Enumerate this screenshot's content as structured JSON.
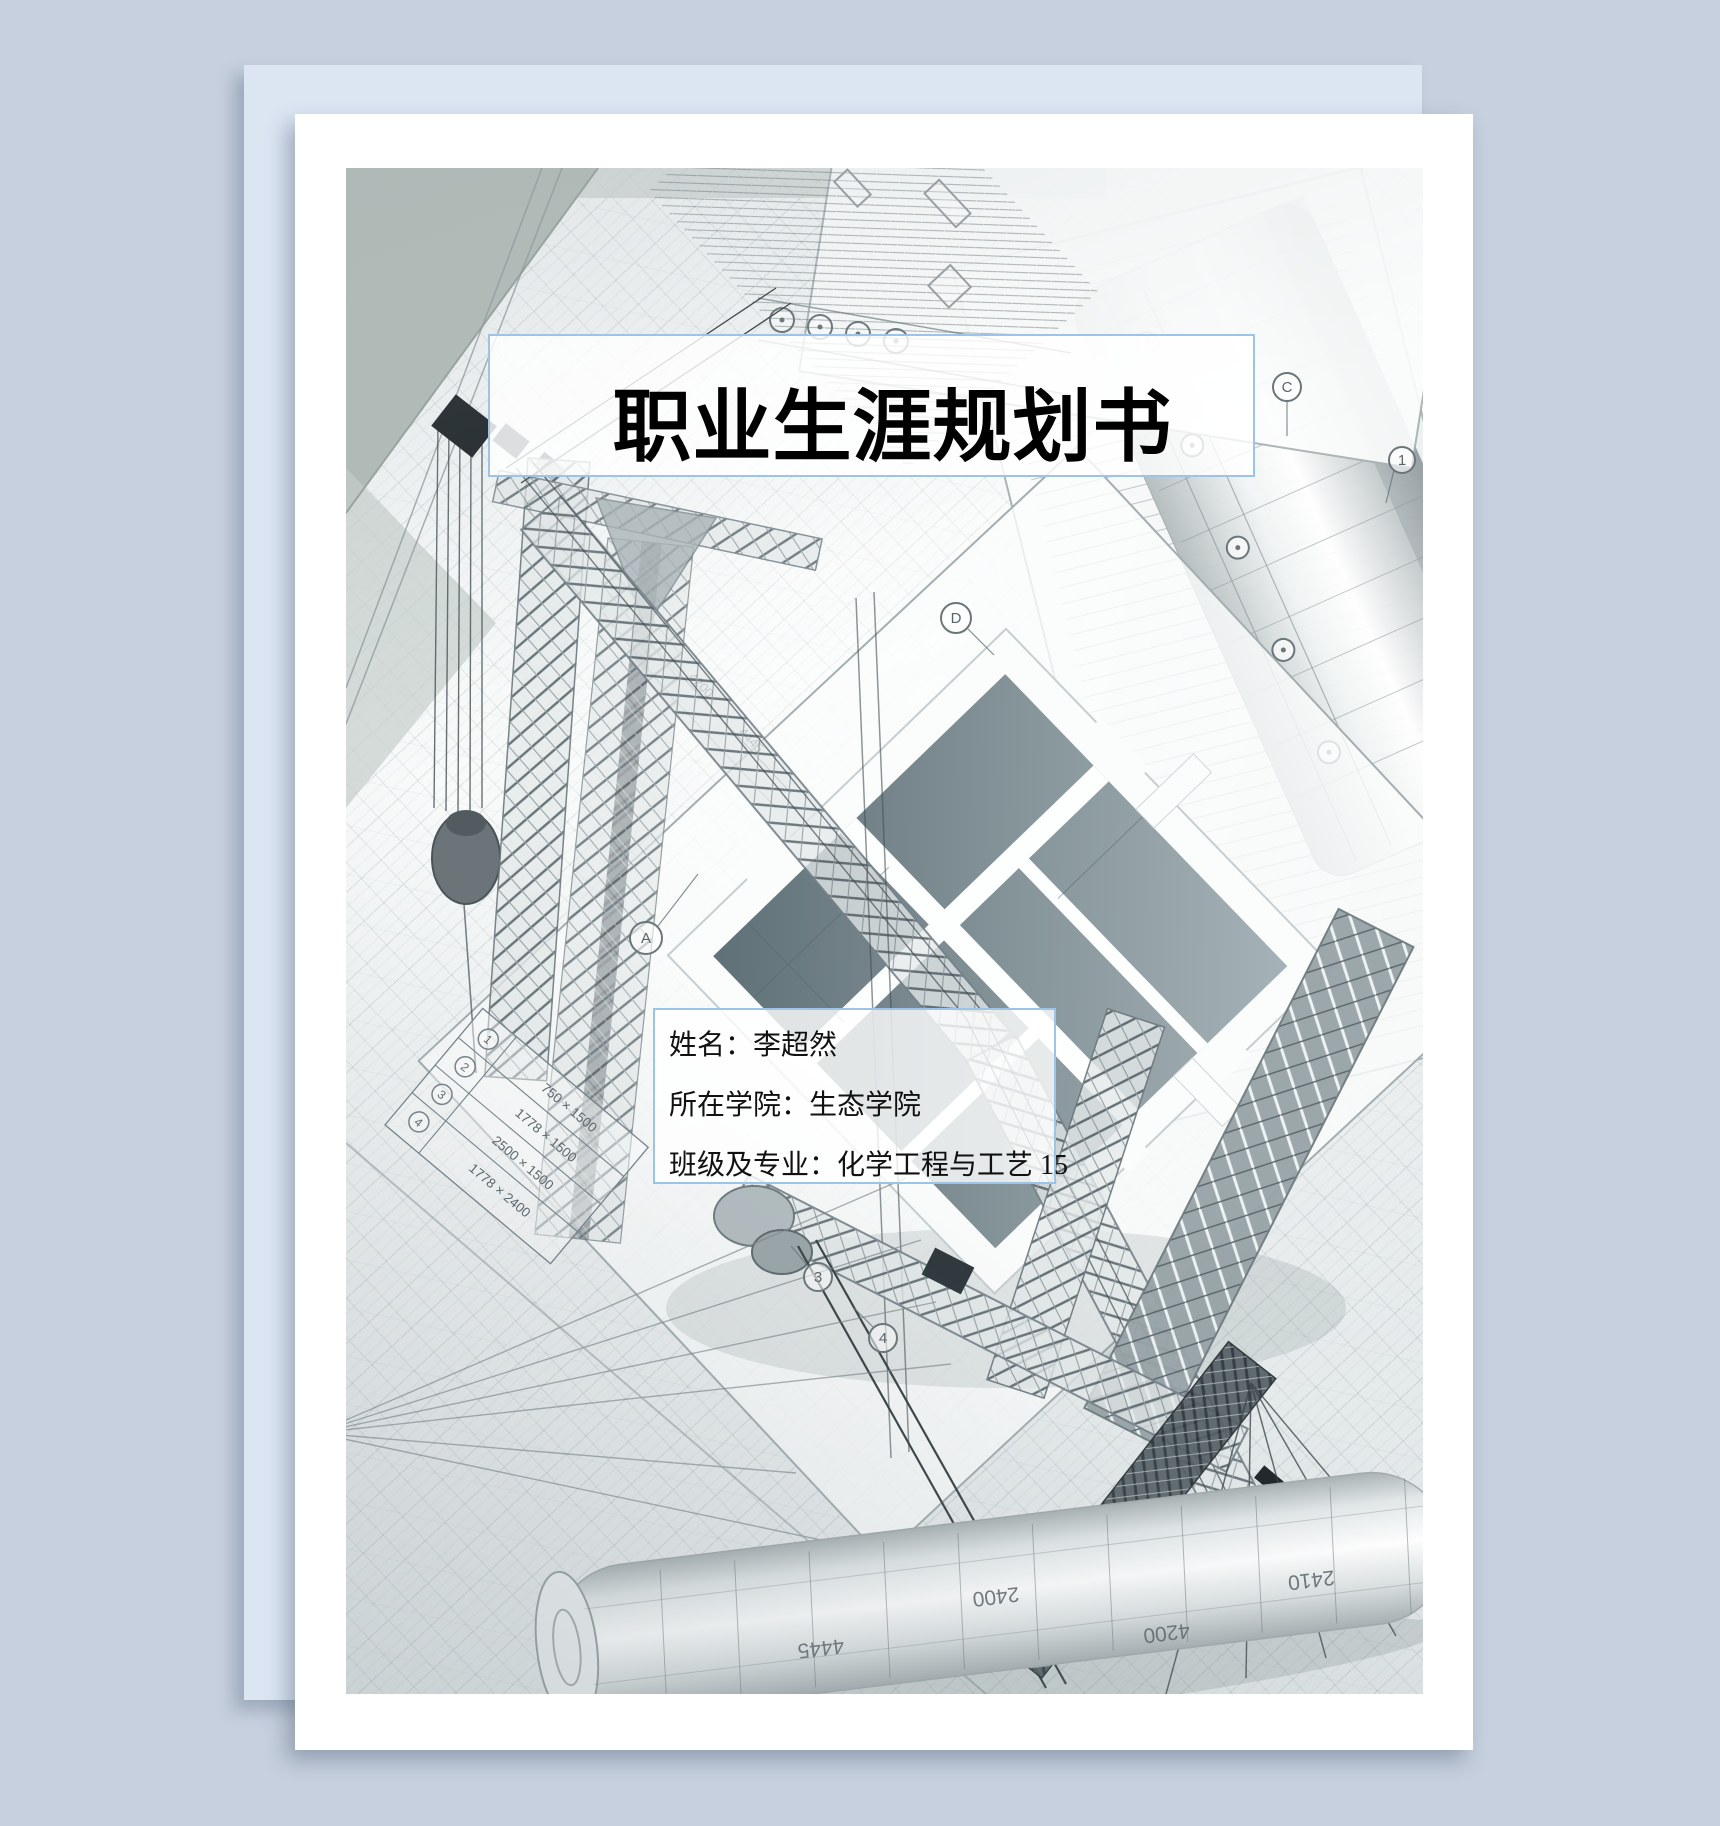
{
  "cover": {
    "title": "职业生涯规划书",
    "fields": [
      {
        "label": "姓名：",
        "value": "李超然"
      },
      {
        "label": "所在学院：",
        "value": "生态学院"
      },
      {
        "label": "班级及专业：",
        "value": "化学工程与工艺 15"
      }
    ]
  },
  "photo": {
    "table": {
      "rows": [
        {
          "num": "1",
          "dim": "750 × 1500"
        },
        {
          "num": "2",
          "dim": "1778 × 1500"
        },
        {
          "num": "3",
          "dim": "2500 × 1500"
        },
        {
          "num": "4",
          "dim": "1778 × 2400"
        }
      ]
    },
    "roll_labels": [
      "4445",
      "2400",
      "4200",
      "2410"
    ],
    "dim_labels": [
      "4200",
      "4445"
    ],
    "grid_markers": [
      "A",
      "C",
      "D",
      "1",
      "3",
      "4"
    ]
  },
  "colors": {
    "canvas_background": "#c6d0de",
    "back_sheet": "#dce6f3",
    "page": "#ffffff",
    "box_border": "#9dc3e6",
    "title_color": "#000000",
    "info_color": "#111111"
  }
}
